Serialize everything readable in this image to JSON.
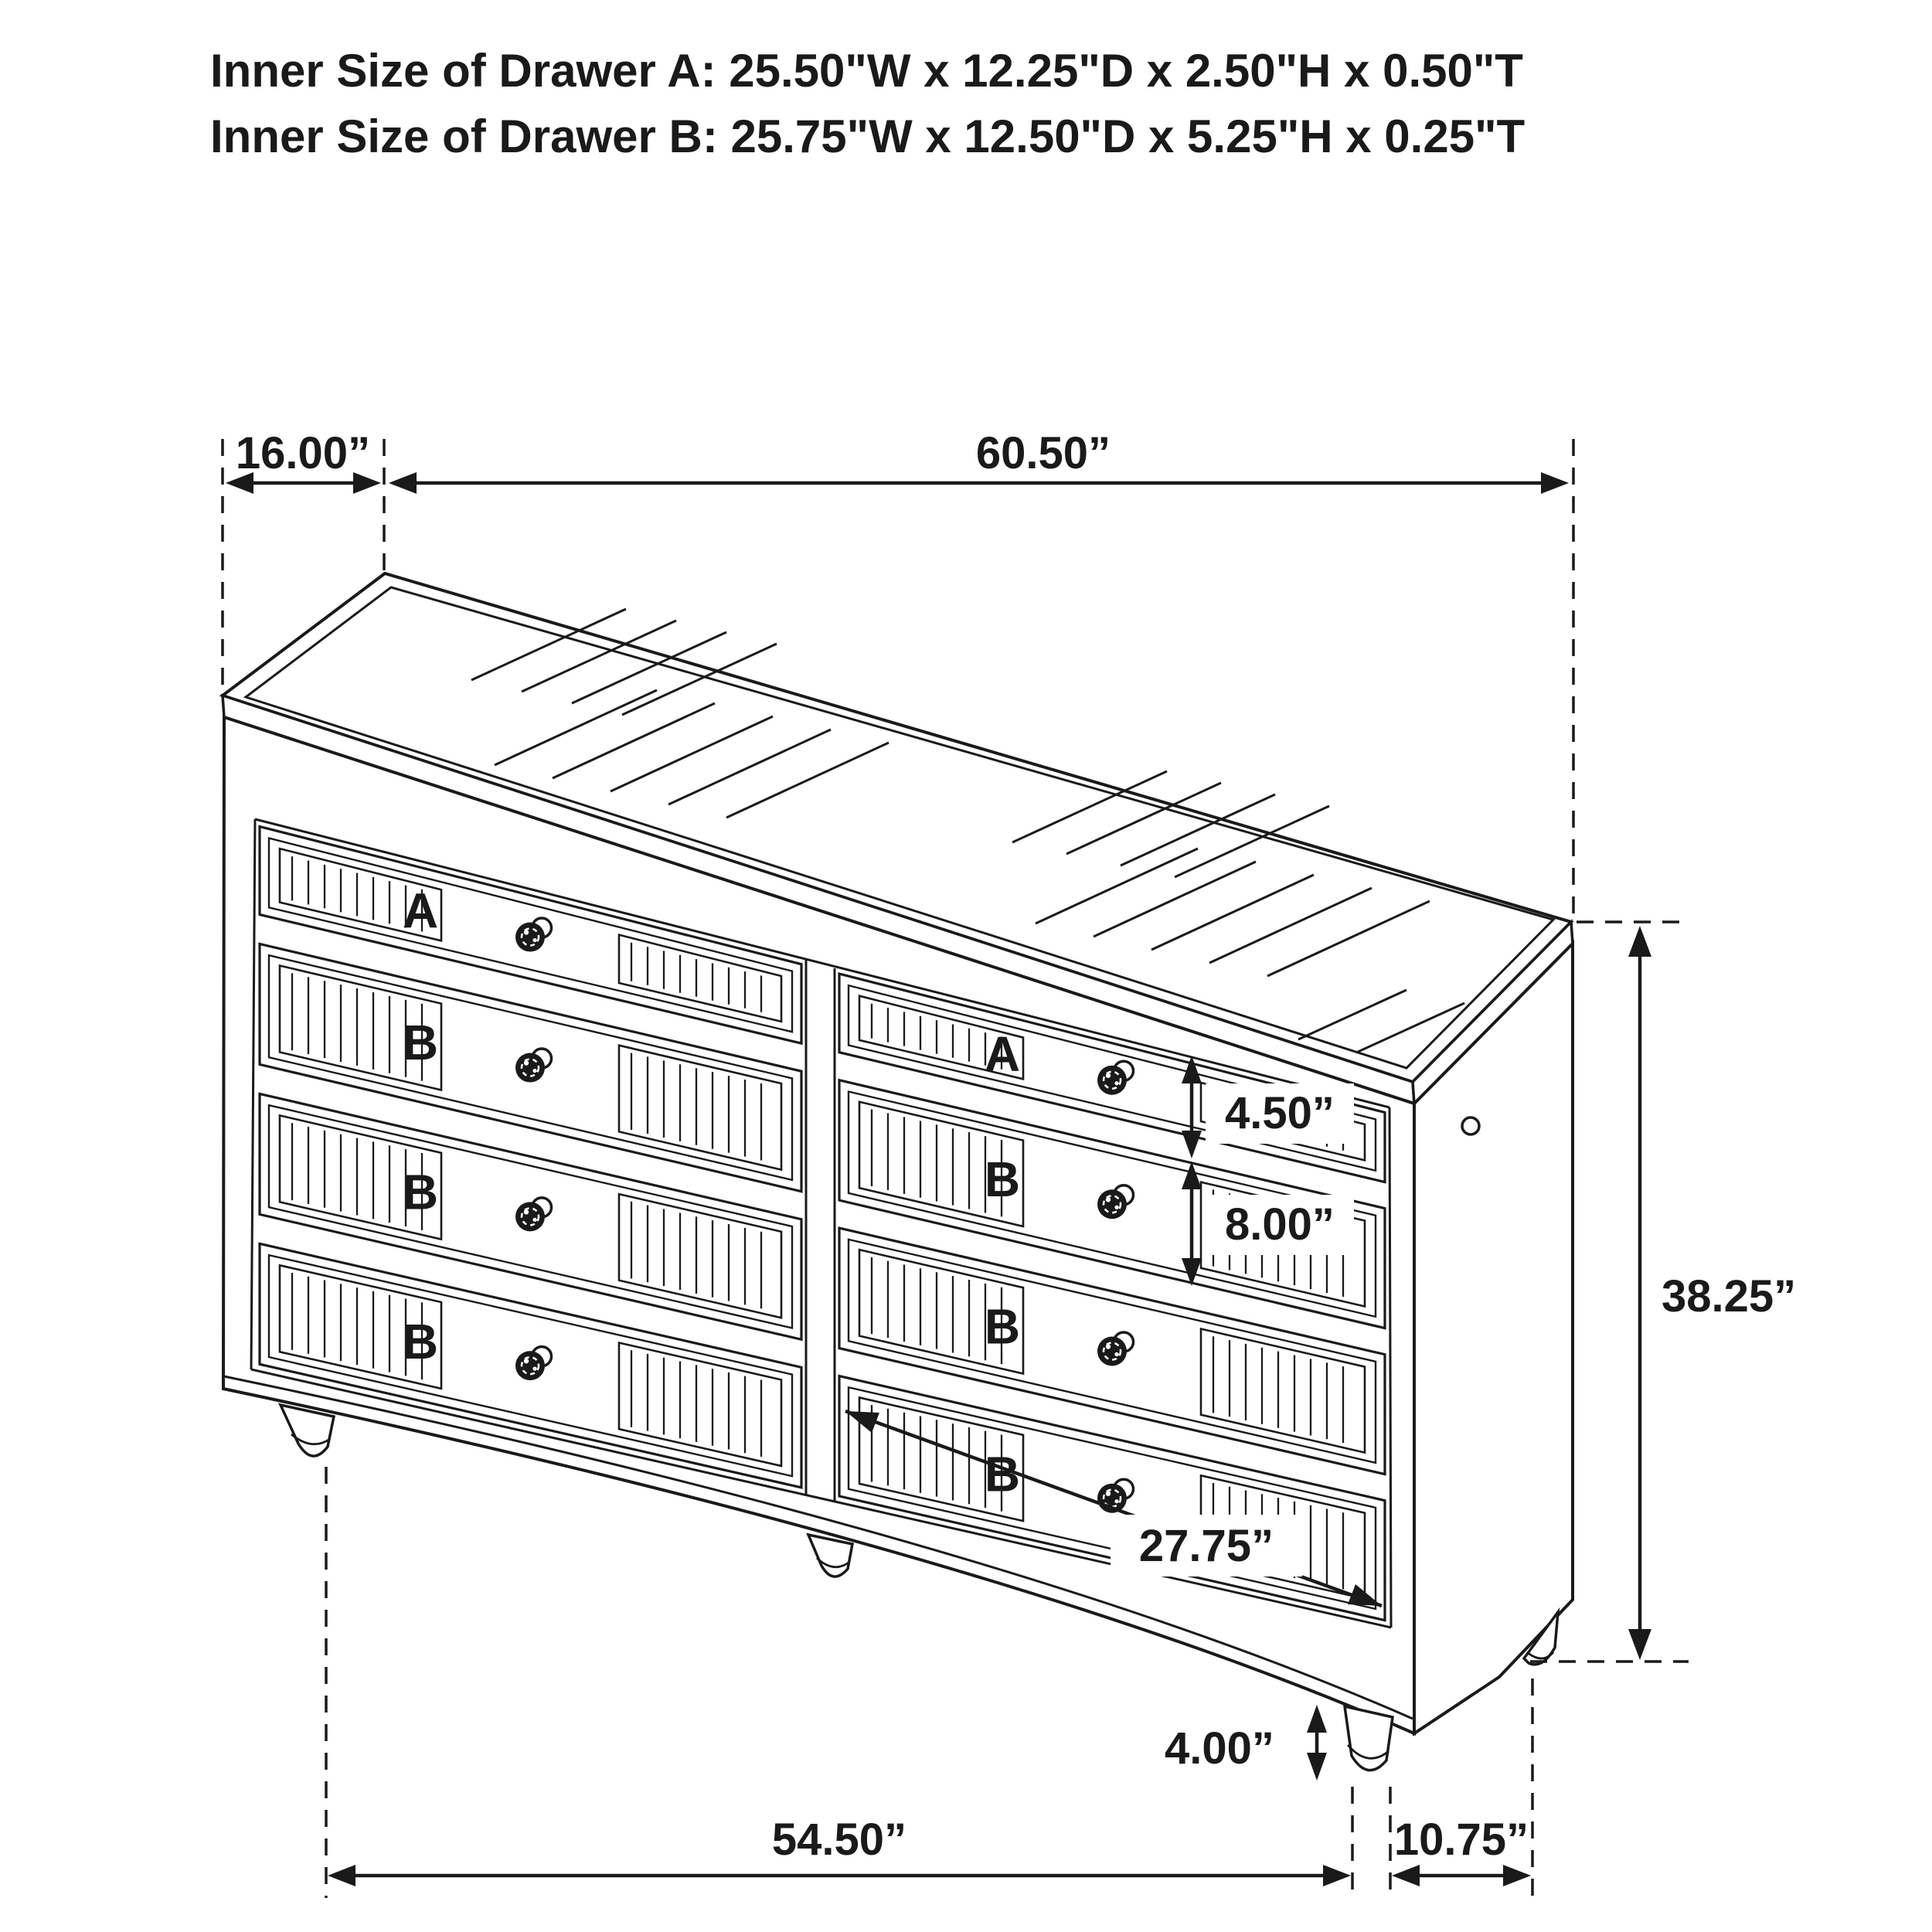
{
  "header": {
    "line1": "Inner Size of Drawer A: 25.50\"W x 12.25\"D x 2.50\"H x 0.50\"T",
    "line2": "Inner Size of Drawer B: 25.75\"W x 12.50\"D x 5.25\"H x 0.25\"T"
  },
  "dimensions": {
    "top_depth": "16.00”",
    "top_width": "60.50”",
    "drawer_a_height": "4.50”",
    "drawer_b_height": "8.00”",
    "overall_height": "38.25”",
    "drawer_inner_width": "27.75”",
    "leg_height": "4.00”",
    "bottom_width": "54.50”",
    "bottom_side_depth": "10.75”"
  },
  "drawer_labels": {
    "left_column": [
      "A",
      "B",
      "B",
      "B"
    ],
    "right_column": [
      "A",
      "B",
      "B",
      "B"
    ]
  },
  "colors": {
    "line": "#1a1a1a",
    "red_label": "#e4252b",
    "background": "#ffffff"
  }
}
